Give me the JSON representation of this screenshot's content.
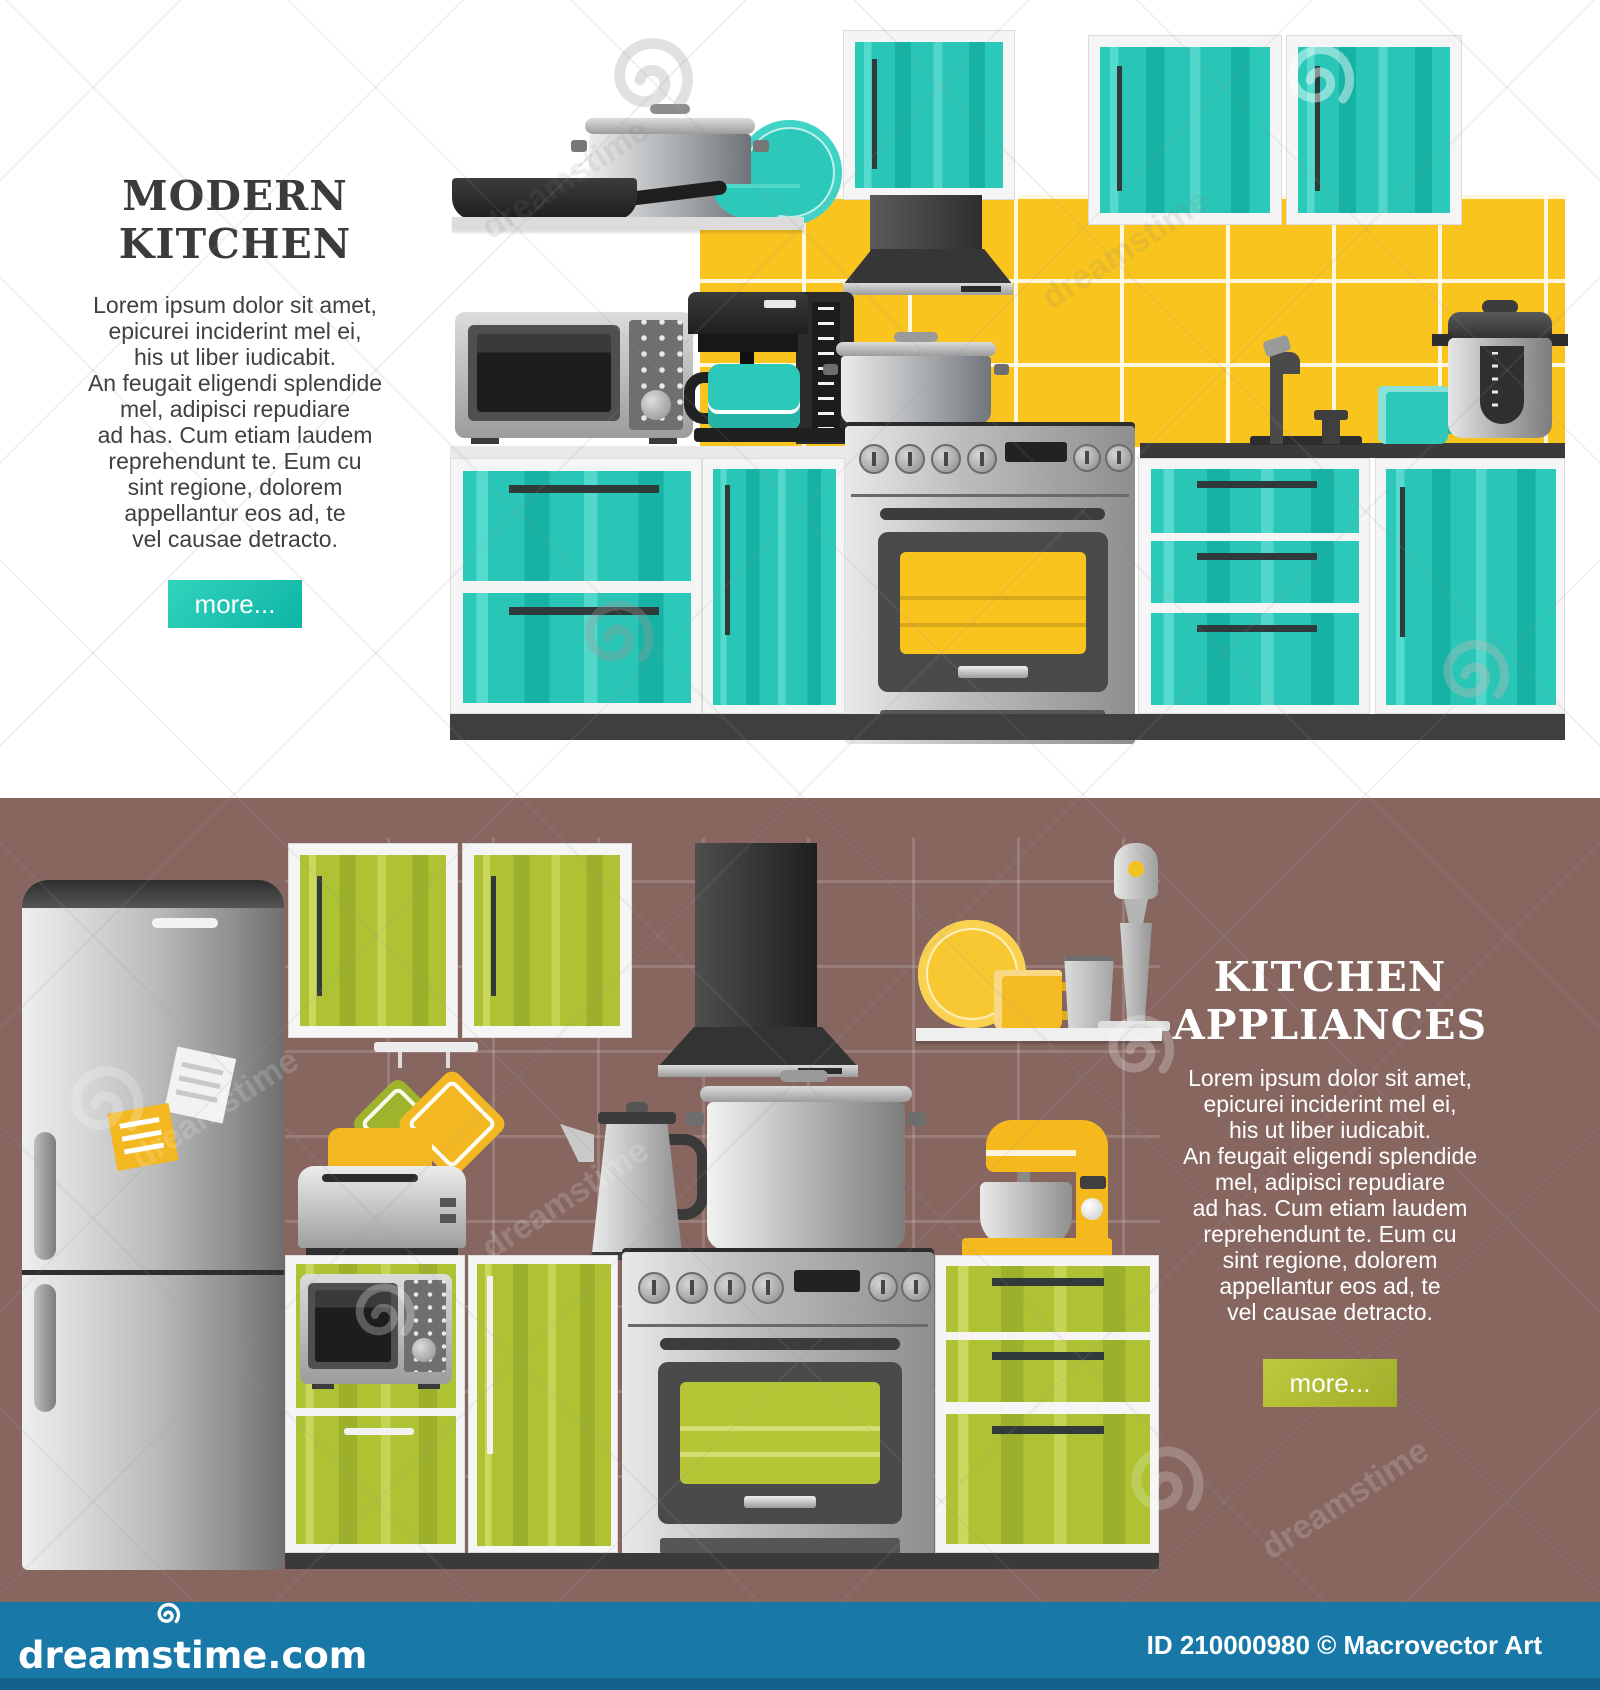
{
  "watermark": {
    "text": "dreamstime"
  },
  "colors": {
    "teal_cabinet": "#29c5b6",
    "yellow_tile": "#f9c41e",
    "green_cabinet": "#aec233",
    "brown_background": "#876660",
    "accent_yellow": "#f3b821",
    "footer_bar_blue": "#1878a8",
    "button_teal": "#14c0ae",
    "button_green": "#aeba32",
    "title_dark": "#3b3b3b",
    "text_light": "#ffffff"
  },
  "lorem": {
    "lines": [
      "Lorem ipsum dolor sit amet,",
      "epicurei inciderint mel ei,",
      "his ut liber iudicabit.",
      "An feugait eligendi splendide",
      "mel, adipisci repudiare",
      "ad has. Cum etiam laudem",
      "reprehendunt te. Eum cu",
      "sint regione, dolorem",
      "appellantur eos ad, te",
      "vel causae detracto."
    ]
  },
  "top_banner": {
    "title_line1": "MODERN",
    "title_line2": "KITCHEN",
    "more_label": "more...",
    "illustration_items": [
      "wall-cabinets",
      "range-hood",
      "shelf",
      "frying-pan",
      "cooking-pot",
      "plate",
      "bowl",
      "microwave",
      "coffee-maker",
      "stove-with-oven",
      "pot-on-stove",
      "sink-faucet",
      "mug",
      "multicooker",
      "drawer-cabinets",
      "door-cabinets",
      "yellow-tile-backsplash"
    ]
  },
  "bottom_banner": {
    "title_line1": "KITCHEN",
    "title_line2": "APPLIANCES",
    "more_label": "more...",
    "illustration_items": [
      "refrigerator",
      "fridge-notes",
      "wall-cabinets",
      "range-hood",
      "shelf",
      "plate",
      "mugs",
      "hand-blender",
      "pot-holders",
      "toaster",
      "electric-kettle",
      "grater",
      "stove-with-oven",
      "cooking-pot",
      "stand-mixer",
      "microwave",
      "drawer-cabinets",
      "door-cabinet"
    ]
  },
  "footer": {
    "site": "dreamstime.com",
    "credit": "ID 210000980 © Macrovector Art"
  }
}
